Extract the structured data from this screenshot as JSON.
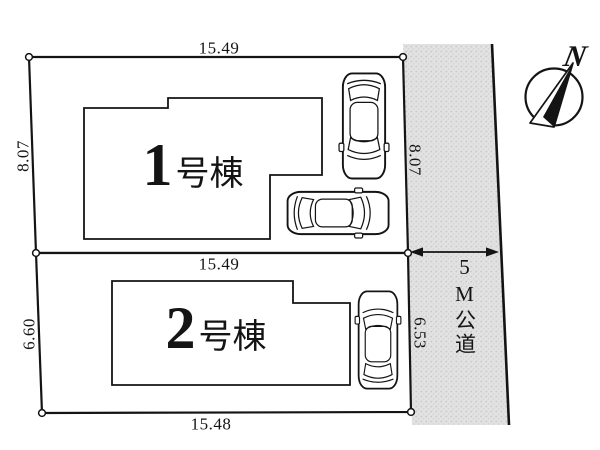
{
  "title": "site-plan",
  "dimensions": {
    "lot1_top": "15.49",
    "lot2_top": "15.49",
    "lot2_bottom": "15.48",
    "left_upper": "8.07",
    "left_lower": "6.60",
    "right_upper": "8.07",
    "right_lower": "6.53"
  },
  "buildings": [
    {
      "number": "1",
      "suffix": "号棟"
    },
    {
      "number": "2",
      "suffix": "号棟"
    }
  ],
  "road": {
    "label": "5M公道"
  },
  "compass": {
    "label": "N"
  },
  "colors": {
    "line": "#141414",
    "road_fill": "#e0e0e0",
    "road_dots": "#c6c6c6",
    "background": "#ffffff"
  }
}
